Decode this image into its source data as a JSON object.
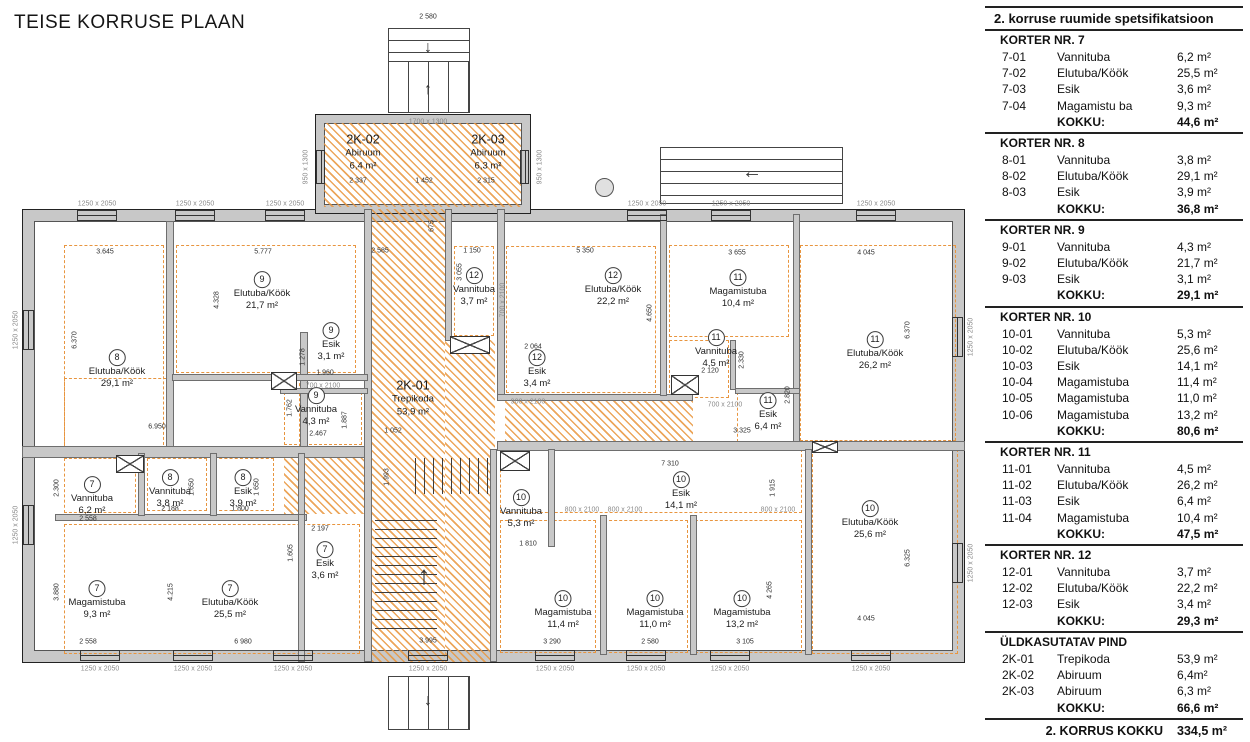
{
  "title": "TEISE KORRUSE PLAAN",
  "spec": {
    "header": "2. korruse ruumide spetsifikatsioon",
    "total_label": "KOKKU:",
    "sections": [
      {
        "title": "KORTER NR. 7",
        "rows": [
          [
            "7-01",
            "Vannituba",
            "6,2 m²"
          ],
          [
            "7-02",
            "Elutuba/Köök",
            "25,5 m²"
          ],
          [
            "7-03",
            "Esik",
            "3,6 m²"
          ],
          [
            "7-04",
            "Magamistu ba",
            "9,3 m²"
          ]
        ],
        "total": "44,6 m²"
      },
      {
        "title": "KORTER NR. 8",
        "rows": [
          [
            "8-01",
            "Vannituba",
            "3,8 m²"
          ],
          [
            "8-02",
            "Elutuba/Köök",
            "29,1 m²"
          ],
          [
            "8-03",
            "Esik",
            "3,9 m²"
          ]
        ],
        "total": "36,8 m²"
      },
      {
        "title": "KORTER NR. 9",
        "rows": [
          [
            "9-01",
            "Vannituba",
            "4,3 m²"
          ],
          [
            "9-02",
            "Elutuba/Köök",
            "21,7 m²"
          ],
          [
            "9-03",
            "Esik",
            "3,1 m²"
          ]
        ],
        "total": "29,1 m²"
      },
      {
        "title": "KORTER NR. 10",
        "rows": [
          [
            "10-01",
            "Vannituba",
            "5,3 m²"
          ],
          [
            "10-02",
            "Elutuba/Köök",
            "25,6 m²"
          ],
          [
            "10-03",
            "Esik",
            "14,1 m²"
          ],
          [
            "10-04",
            "Magamistuba",
            "11,4 m²"
          ],
          [
            "10-05",
            "Magamistuba",
            "11,0 m²"
          ],
          [
            "10-06",
            "Magamistuba",
            "13,2 m²"
          ]
        ],
        "total": "80,6 m²"
      },
      {
        "title": "KORTER NR. 11",
        "rows": [
          [
            "11-01",
            "Vannituba",
            "4,5 m²"
          ],
          [
            "11-02",
            "Elutuba/Köök",
            "26,2 m²"
          ],
          [
            "11-03",
            "Esik",
            "6,4 m²"
          ],
          [
            "11-04",
            "Magamistuba",
            "10,4 m²"
          ]
        ],
        "total": "47,5 m²"
      },
      {
        "title": "KORTER NR. 12",
        "rows": [
          [
            "12-01",
            "Vannituba",
            "3,7 m²"
          ],
          [
            "12-02",
            "Elutuba/Köök",
            "22,2 m²"
          ],
          [
            "12-03",
            "Esik",
            "3,4 m²"
          ]
        ],
        "total": "29,3 m²"
      },
      {
        "title": "ÜLDKASUTATAV PIND",
        "rows": [
          [
            "2K-01",
            "Trepikoda",
            "53,9 m²"
          ],
          [
            "2K-02",
            "Abiruum",
            "6,4m²"
          ],
          [
            "2K-03",
            "Abiruum",
            "6,3 m²"
          ]
        ],
        "total": "66,6 m²"
      }
    ],
    "footer_label": "2. KORRUS KOKKU",
    "footer_value": "334,5 m²"
  },
  "plan": {
    "rooms": [
      {
        "code": "2K-02",
        "name": "Abiruum",
        "area": "6,4 m²",
        "x": 363,
        "y": 152
      },
      {
        "code": "2K-03",
        "name": "Abiruum",
        "area": "6,3 m²",
        "x": 488,
        "y": 152
      },
      {
        "code": "2K-01",
        "name": "Trepikoda",
        "area": "53,9 m²",
        "x": 413,
        "y": 398
      },
      {
        "circle": "8",
        "name": "Elutuba/Köök",
        "area": "29,1 m²",
        "x": 117,
        "y": 370
      },
      {
        "circle": "9",
        "name": "Elutuba/Köök",
        "area": "21,7 m²",
        "x": 262,
        "y": 292
      },
      {
        "circle": "9",
        "name": "Esik",
        "area": "3,1 m²",
        "x": 331,
        "y": 343
      },
      {
        "circle": "9",
        "name": "Vannituba",
        "area": "4,3 m²",
        "x": 316,
        "y": 408
      },
      {
        "circle": "12",
        "name": "Vannituba",
        "area": "3,7 m²",
        "x": 474,
        "y": 288
      },
      {
        "circle": "12",
        "name": "Elutuba/Köök",
        "area": "22,2 m²",
        "x": 613,
        "y": 288
      },
      {
        "circle": "12",
        "name": "Esik",
        "area": "3,4 m²",
        "x": 537,
        "y": 370
      },
      {
        "circle": "11",
        "name": "Magamistuba",
        "area": "10,4 m²",
        "x": 738,
        "y": 290
      },
      {
        "circle": "11",
        "name": "Vannituba",
        "area": "4,5 m²",
        "x": 716,
        "y": 350
      },
      {
        "circle": "11",
        "name": "Esik",
        "area": "6,4 m²",
        "x": 768,
        "y": 413
      },
      {
        "circle": "11",
        "name": "Elutuba/Köök",
        "area": "26,2 m²",
        "x": 875,
        "y": 352
      },
      {
        "circle": "7",
        "name": "Vannituba",
        "area": "6,2 m²",
        "x": 92,
        "y": 497
      },
      {
        "circle": "8",
        "name": "Vannituba",
        "area": "3,8 m²",
        "x": 170,
        "y": 490
      },
      {
        "circle": "8",
        "name": "Esik",
        "area": "3,9 m²",
        "x": 243,
        "y": 490
      },
      {
        "circle": "7",
        "name": "Magamistuba",
        "area": "9,3 m²",
        "x": 97,
        "y": 601
      },
      {
        "circle": "7",
        "name": "Elutuba/Köök",
        "area": "25,5 m²",
        "x": 230,
        "y": 601
      },
      {
        "circle": "7",
        "name": "Esik",
        "area": "3,6 m²",
        "x": 325,
        "y": 562
      },
      {
        "circle": "10",
        "name": "Vannituba",
        "area": "5,3 m²",
        "x": 521,
        "y": 510
      },
      {
        "circle": "10",
        "name": "Esik",
        "area": "14,1 m²",
        "x": 681,
        "y": 492
      },
      {
        "circle": "10",
        "name": "Magamistuba",
        "area": "11,4 m²",
        "x": 563,
        "y": 611
      },
      {
        "circle": "10",
        "name": "Magamistuba",
        "area": "11,0 m²",
        "x": 655,
        "y": 611
      },
      {
        "circle": "10",
        "name": "Magamistuba",
        "area": "13,2 m²",
        "x": 742,
        "y": 611
      },
      {
        "circle": "10",
        "name": "Elutuba/Köök",
        "area": "25,6 m²",
        "x": 870,
        "y": 521
      }
    ],
    "labels": [
      {
        "t": "2 580",
        "x": 428,
        "y": 17
      },
      {
        "t": "2 337",
        "x": 358,
        "y": 181
      },
      {
        "t": "1 452",
        "x": 424,
        "y": 181
      },
      {
        "t": "2 315",
        "x": 486,
        "y": 181
      },
      {
        "t": "675",
        "x": 432,
        "y": 226,
        "r": 1
      },
      {
        "t": "2 585",
        "x": 380,
        "y": 251
      },
      {
        "t": "1 150",
        "x": 472,
        "y": 251
      },
      {
        "t": "5 350",
        "x": 585,
        "y": 251
      },
      {
        "t": "3 655",
        "x": 737,
        "y": 253
      },
      {
        "t": "4 045",
        "x": 866,
        "y": 253
      },
      {
        "t": "3.645",
        "x": 105,
        "y": 252
      },
      {
        "t": "5.777",
        "x": 263,
        "y": 252
      },
      {
        "t": "6.370",
        "x": 75,
        "y": 340,
        "r": 1
      },
      {
        "t": "4.328",
        "x": 217,
        "y": 300,
        "r": 1
      },
      {
        "t": "3 055",
        "x": 460,
        "y": 272,
        "r": 1
      },
      {
        "t": "4.650",
        "x": 650,
        "y": 313,
        "r": 1
      },
      {
        "t": "6.370",
        "x": 908,
        "y": 330,
        "r": 1
      },
      {
        "t": "2 064",
        "x": 533,
        "y": 347
      },
      {
        "t": "1.278",
        "x": 303,
        "y": 357,
        "r": 1
      },
      {
        "t": "1.960",
        "x": 325,
        "y": 373
      },
      {
        "t": "2.330",
        "x": 742,
        "y": 360,
        "r": 1
      },
      {
        "t": "2 120",
        "x": 710,
        "y": 371
      },
      {
        "t": "1.762",
        "x": 290,
        "y": 408,
        "r": 1
      },
      {
        "t": "2.820",
        "x": 788,
        "y": 395,
        "r": 1
      },
      {
        "t": "6.950",
        "x": 157,
        "y": 427
      },
      {
        "t": "2.467",
        "x": 318,
        "y": 434
      },
      {
        "t": "3.325",
        "x": 742,
        "y": 431
      },
      {
        "t": "1 052",
        "x": 393,
        "y": 431
      },
      {
        "t": "1.887",
        "x": 345,
        "y": 420,
        "r": 1
      },
      {
        "t": "2.300",
        "x": 57,
        "y": 488,
        "r": 1
      },
      {
        "t": "1.650",
        "x": 192,
        "y": 487,
        "r": 1
      },
      {
        "t": "1 650",
        "x": 257,
        "y": 487,
        "r": 1
      },
      {
        "t": "2 188",
        "x": 170,
        "y": 509
      },
      {
        "t": "1 800",
        "x": 240,
        "y": 509
      },
      {
        "t": "2 558",
        "x": 88,
        "y": 519
      },
      {
        "t": "7 310",
        "x": 670,
        "y": 464
      },
      {
        "t": "1 915",
        "x": 773,
        "y": 488,
        "r": 1
      },
      {
        "t": "2 197",
        "x": 320,
        "y": 529
      },
      {
        "t": "1.605",
        "x": 291,
        "y": 553,
        "r": 1
      },
      {
        "t": "1 810",
        "x": 528,
        "y": 544
      },
      {
        "t": "3.880",
        "x": 57,
        "y": 592,
        "r": 1
      },
      {
        "t": "4.215",
        "x": 171,
        "y": 592,
        "r": 1
      },
      {
        "t": "4 265",
        "x": 770,
        "y": 590,
        "r": 1
      },
      {
        "t": "6.325",
        "x": 908,
        "y": 558,
        "r": 1
      },
      {
        "t": "1.993",
        "x": 387,
        "y": 477,
        "r": 1
      },
      {
        "t": "2 558",
        "x": 88,
        "y": 642
      },
      {
        "t": "6 980",
        "x": 243,
        "y": 642
      },
      {
        "t": "3 290",
        "x": 552,
        "y": 642
      },
      {
        "t": "2 580",
        "x": 650,
        "y": 642
      },
      {
        "t": "3 105",
        "x": 745,
        "y": 642
      },
      {
        "t": "4 045",
        "x": 866,
        "y": 619
      },
      {
        "t": "3.995",
        "x": 428,
        "y": 641
      },
      {
        "t": "1700 x 1300",
        "x": 428,
        "y": 122,
        "c": "w"
      },
      {
        "t": "950 x 1300",
        "x": 306,
        "y": 167,
        "r": 1,
        "c": "w"
      },
      {
        "t": "950 x 1300",
        "x": 540,
        "y": 167,
        "r": 1,
        "c": "w"
      },
      {
        "t": "1250 x 2050",
        "x": 97,
        "y": 204,
        "c": "w"
      },
      {
        "t": "1250 x 2050",
        "x": 195,
        "y": 204,
        "c": "w"
      },
      {
        "t": "1250 x 2050",
        "x": 285,
        "y": 204,
        "c": "w"
      },
      {
        "t": "1250 x 2050",
        "x": 647,
        "y": 204,
        "c": "w"
      },
      {
        "t": "1250 x 2050",
        "x": 731,
        "y": 204,
        "c": "w"
      },
      {
        "t": "1250 x 2050",
        "x": 876,
        "y": 204,
        "c": "w"
      },
      {
        "t": "1250 x 2050",
        "x": 100,
        "y": 669,
        "c": "w"
      },
      {
        "t": "1250 x 2050",
        "x": 193,
        "y": 669,
        "c": "w"
      },
      {
        "t": "1250 x 2050",
        "x": 293,
        "y": 669,
        "c": "w"
      },
      {
        "t": "1250 x 2050",
        "x": 428,
        "y": 669,
        "c": "w"
      },
      {
        "t": "1250 x 2050",
        "x": 555,
        "y": 669,
        "c": "w"
      },
      {
        "t": "1250 x 2050",
        "x": 646,
        "y": 669,
        "c": "w"
      },
      {
        "t": "1250 x 2050",
        "x": 730,
        "y": 669,
        "c": "w"
      },
      {
        "t": "1250 x 2050",
        "x": 871,
        "y": 669,
        "c": "w"
      },
      {
        "t": "1250 x 2050",
        "x": 16,
        "y": 330,
        "r": 1,
        "c": "w"
      },
      {
        "t": "1250 x 2050",
        "x": 16,
        "y": 525,
        "r": 1,
        "c": "w"
      },
      {
        "t": "1250 x 2050",
        "x": 971,
        "y": 337,
        "r": 1,
        "c": "w"
      },
      {
        "t": "1250 x 2050",
        "x": 971,
        "y": 563,
        "r": 1,
        "c": "w"
      },
      {
        "t": "700 x 2100",
        "x": 323,
        "y": 386,
        "c": "w"
      },
      {
        "t": "700 x 2100",
        "x": 725,
        "y": 405,
        "c": "w"
      },
      {
        "t": "700 x 2100",
        "x": 503,
        "y": 300,
        "r": 1,
        "c": "w"
      },
      {
        "t": "900 x 2100",
        "x": 528,
        "y": 402,
        "c": "w"
      },
      {
        "t": "800 x 2100",
        "x": 582,
        "y": 510,
        "c": "w"
      },
      {
        "t": "800 x 2100",
        "x": 625,
        "y": 510,
        "c": "w"
      },
      {
        "t": "800 x 2100",
        "x": 778,
        "y": 510,
        "c": "w"
      }
    ],
    "arrows": [
      {
        "g": "↓",
        "x": 428,
        "y": 48,
        "s": 16
      },
      {
        "g": "↑",
        "x": 428,
        "y": 90,
        "s": 16
      },
      {
        "g": "←",
        "x": 752,
        "y": 172,
        "s": 20
      },
      {
        "g": "↑",
        "x": 424,
        "y": 575,
        "s": 26
      },
      {
        "g": "↓",
        "x": 428,
        "y": 701,
        "s": 16
      }
    ]
  }
}
